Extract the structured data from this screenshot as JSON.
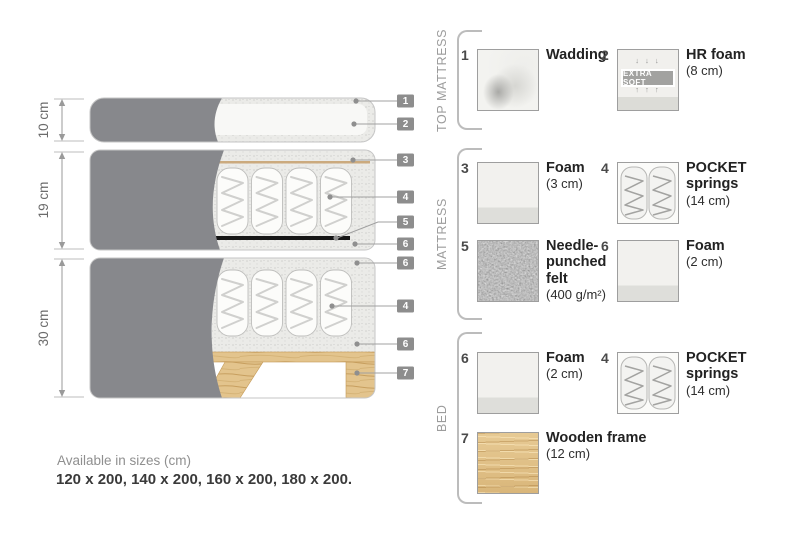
{
  "diagram": {
    "dims": [
      "10 cm",
      "19 cm",
      "30 cm"
    ],
    "tags": [
      "1",
      "2",
      "3",
      "4",
      "5",
      "6",
      "6",
      "4",
      "6",
      "7"
    ],
    "colors": {
      "fabric_cover": "#87888c",
      "foam_speckle": "#ebebe8",
      "wood": "#e2c28c",
      "felt_strip": "#151515",
      "tag_background": "#8d8d8d",
      "leader_line": "#a0a0a0"
    }
  },
  "legend": {
    "sections": [
      {
        "label": "TOP MATTRESS",
        "items": [
          {
            "number": "1",
            "name": "Wadding",
            "size": ""
          },
          {
            "number": "2",
            "name": "HR foam",
            "size": "(8 cm)",
            "badge": "EXTRA SOFT",
            "arrows_down": "↓ ↓ ↓",
            "arrows_up": "↑ ↑ ↑"
          }
        ]
      },
      {
        "label": "MATTRESS",
        "items": [
          {
            "number": "3",
            "name": "Foam",
            "size": "(3 cm)"
          },
          {
            "number": "4",
            "name": "POCKET springs",
            "size": "(14 cm)"
          },
          {
            "number": "5",
            "name": "Needle-punched felt",
            "size": "(400 g/m²)"
          },
          {
            "number": "6",
            "name": "Foam",
            "size": "(2 cm)"
          }
        ]
      },
      {
        "label": "BED",
        "items": [
          {
            "number": "6",
            "name": "Foam",
            "size": "(2 cm)"
          },
          {
            "number": "4",
            "name": "POCKET springs",
            "size": "(14 cm)"
          },
          {
            "number": "7",
            "name": "Wooden frame",
            "size": "(12 cm)"
          }
        ]
      }
    ]
  },
  "footer": {
    "availability": "Available in sizes (cm)",
    "sizes": "120 x 200, 140 x 200, 160 x 200, 180 x 200."
  }
}
